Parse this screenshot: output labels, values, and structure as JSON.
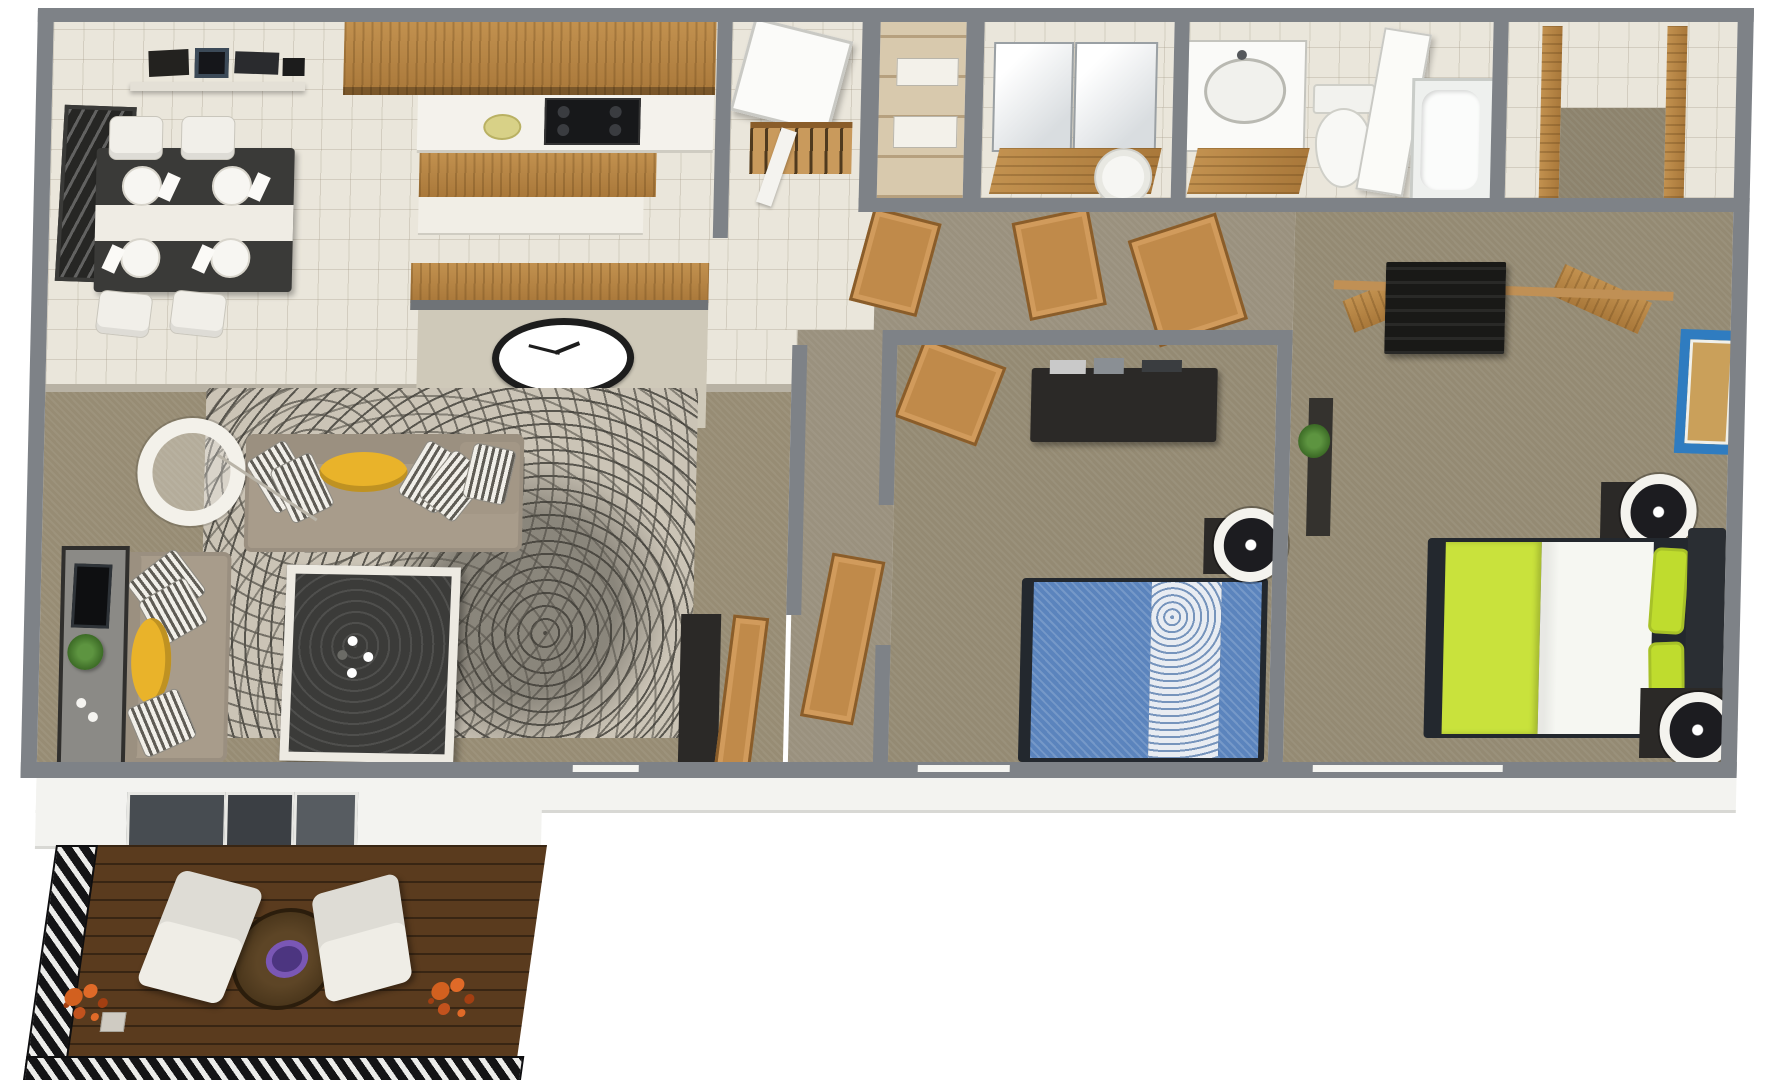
{
  "image_type": "3d-floor-plan-top-view",
  "description": "3D rendered top-down floor plan of a two-bedroom, one-and-a-half-bath apartment with balcony deck",
  "palette": {
    "wall_gray": "#7e8287",
    "tile_cream": "#eae6db",
    "living_carpet": "#978c74",
    "bedroom_carpet": "#948a73",
    "hallway_carpet": "#9a917e",
    "rug_base": "#cbc4b6",
    "rug_swirl": "#57544c",
    "cabinet_wood": "#b5813f",
    "deck_wood": "#5a3b1e",
    "sofa_taupe": "#a89c8b",
    "accent_yellow": "#e9b32a",
    "bed_blue": "#5b84bd",
    "bed_green": "#c9e23c",
    "picture_frame_blue": "#2f7cc0",
    "plant_green": "#4e8030",
    "deck_plant_orange": "#d2601f",
    "white_fixture": "#f4f3ee"
  },
  "rooms": {
    "dining": {
      "name": "Dining Area",
      "furniture": [
        "dark dining table with white runner",
        "4 white chairs",
        "4 white place settings",
        "dark wall art",
        "floating shelf with black electronics"
      ]
    },
    "kitchen": {
      "name": "Kitchen",
      "furniture": [
        "upper wood cabinets",
        "white counter",
        "black cooktop",
        "wood island counter",
        "breakfast bar with oval wall clock"
      ]
    },
    "entry": {
      "name": "Entry",
      "furniture": [
        "open white front door",
        "coat closet with hanger rod"
      ]
    },
    "linen_closet": {
      "name": "Linen Closet",
      "furniture": [
        "wood shelves with white linens"
      ]
    },
    "bathroom_vanity": {
      "name": "Bathroom - Vanity Side",
      "furniture": [
        "double mirror cabinet",
        "wood vanity",
        "toilet"
      ]
    },
    "bathroom_main": {
      "name": "Bathroom - Tub Side",
      "furniture": [
        "sink vanity with oval basin",
        "toilet",
        "open white door",
        "bathtub"
      ]
    },
    "closet_top_right": {
      "name": "Walk-in Closet",
      "furniture": [
        "wood posts",
        "carpet inset"
      ]
    },
    "hallway": {
      "name": "Hallway",
      "furniture": [
        "three open wood doors"
      ]
    },
    "living": {
      "name": "Living Room",
      "furniture": [
        "L sofa with yellow bolster and striped pillows",
        "second taupe sofa",
        "glass coffee table with white flowers",
        "patterned swirl rug",
        "TV console with TV and plant",
        "white arc floor lamp",
        "tall dark wardrobe",
        "wood doors to hall"
      ]
    },
    "bedroom_1": {
      "name": "Bedroom 1",
      "furniture": [
        "blue double bed with patterned runner",
        "dark dresser with electronics",
        "nightstand with white ring lamp",
        "open wood door"
      ]
    },
    "bedroom_2": {
      "name": "Bedroom 2",
      "furniture": [
        "green and white double bed",
        "black dresser",
        "open wood closet doors",
        "blue picture frame",
        "two nightstands with white ring lamps",
        "plant",
        "dark ledge"
      ]
    },
    "deck": {
      "name": "Balcony Deck",
      "furniture": [
        "plank wood floor",
        "black-and-white hatched railing",
        "two white lounge chairs",
        "round wood table with purple centerpiece",
        "two orange plants",
        "white planter box"
      ]
    }
  }
}
